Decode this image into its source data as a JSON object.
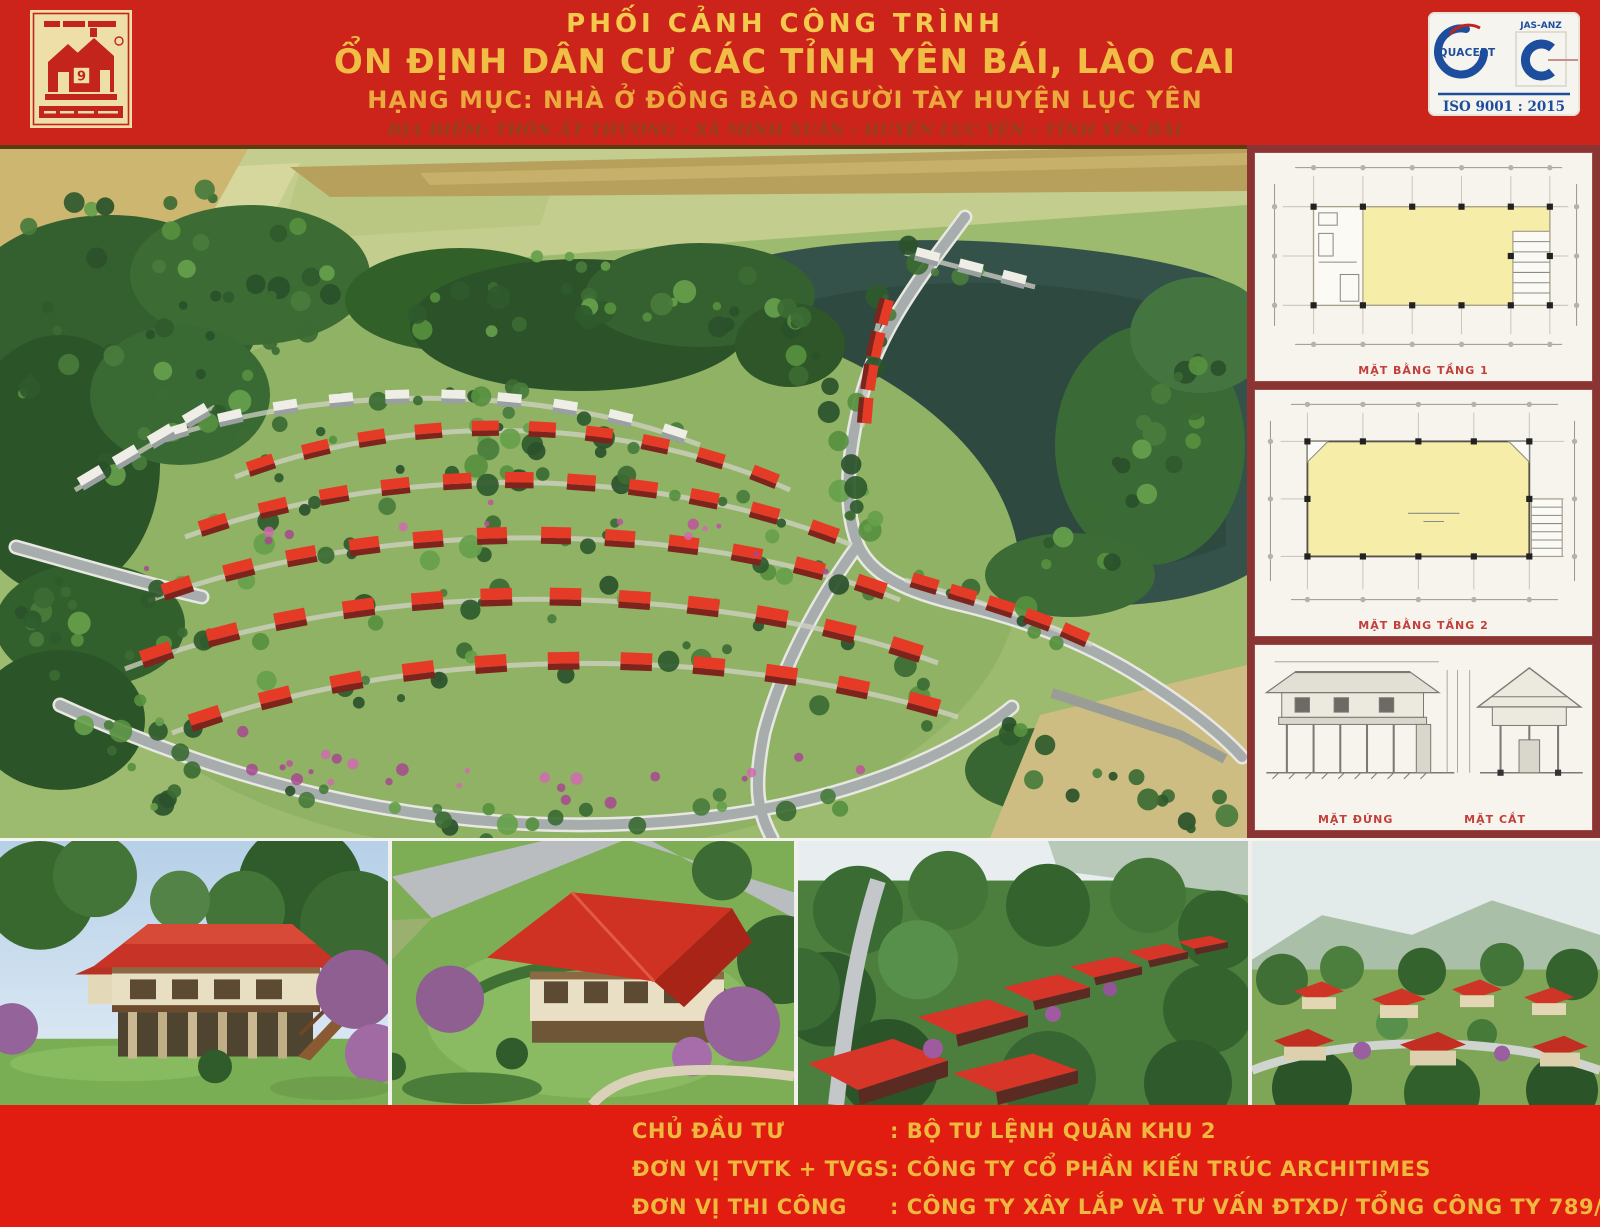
{
  "header": {
    "line1": "PHỐI CẢNH CÔNG TRÌNH",
    "line2": "ỔN ĐỊNH DÂN CƯ CÁC TỈNH YÊN BÁI, LÀO CAI",
    "line3": "HẠNG MỤC: NHÀ Ở ĐỒNG BÀO NGƯỜI TÀY HUYỆN LỤC YÊN",
    "location": "ĐỊA ĐIỂM: THÔN ẤT THƯỢNG - XÃ MINH XUÂN - HUYỆN LỤC YÊN - TỈNH YÊN BÁI",
    "logo": {
      "digit": "9"
    },
    "cert": {
      "brand1": "QUACERT",
      "brand2": "JAS-ANZ",
      "iso": "ISO 9001 : 2015"
    }
  },
  "plans": [
    {
      "caption": "MẶT BẰNG TẦNG 1"
    },
    {
      "caption": "MẶT BẰNG TẦNG 2"
    },
    {
      "caption_left": "MẶT ĐỨNG",
      "caption_right": "MẶT CẮT"
    }
  ],
  "footer": {
    "rows": [
      {
        "label": "CHỦ ĐẦU TƯ",
        "value": ": BỘ TƯ LỆNH QUÂN KHU 2"
      },
      {
        "label": "ĐƠN VỊ TVTK + TVGS",
        "value": ": CÔNG TY CỔ PHẦN KIẾN TRÚC ARCHITIMES"
      },
      {
        "label": "ĐƠN VỊ THI CÔNG",
        "value": ": CÔNG TY XÂY LẮP VÀ TƯ VẤN ĐTXD/ TỔNG CÔNG TY 789/ BQP"
      }
    ]
  },
  "colors": {
    "poster_red": "#cc241a",
    "footer_red": "#e01d10",
    "title_gold": "#f0bd45",
    "location_brown": "#93421c",
    "sidebar_maroon": "#8a3533",
    "plan_yellow": "#f5eda8",
    "roof_red": "#e53b26",
    "cert_blue": "#1d4e9e",
    "logo_gold": "#eedfa8"
  }
}
